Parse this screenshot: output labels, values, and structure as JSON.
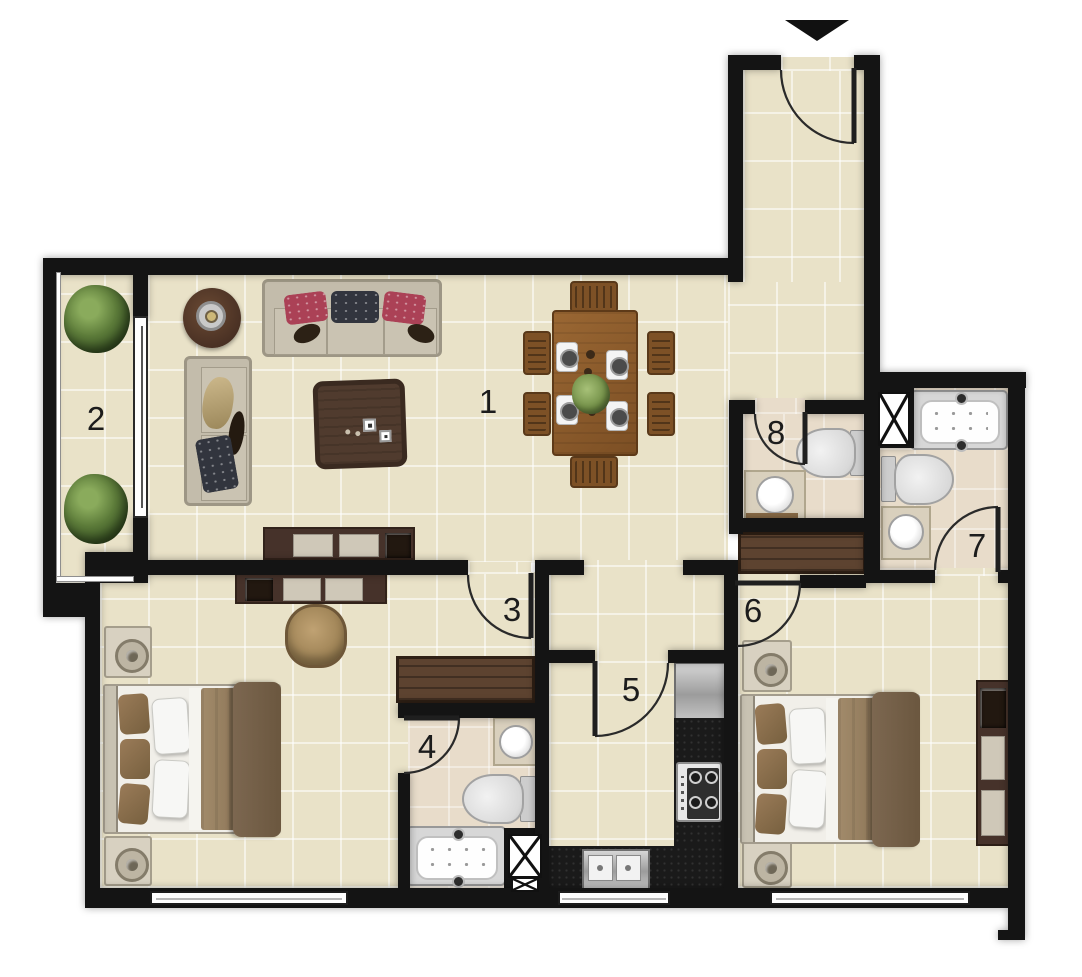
{
  "rooms": [
    {
      "label": "1"
    },
    {
      "label": "2"
    },
    {
      "label": "3"
    },
    {
      "label": "4"
    },
    {
      "label": "5"
    },
    {
      "label": "6"
    },
    {
      "label": "7"
    },
    {
      "label": "8"
    }
  ],
  "icons": {
    "entrance_arrow": "triangle-down"
  },
  "colors": {
    "wall": "#141414",
    "floor": "#e9e2c8",
    "bath_floor": "#e8dcca",
    "wood": "#95622f",
    "furn_dark": "#46322a",
    "sofa": "#c3bcab",
    "counter": "#1a1a1a",
    "stand": "#d8d1c1",
    "wardrobe": "#5d4330",
    "pillow_red": "#ab4156",
    "pillow_dark": "#32353e",
    "plant_green": "#5d7c3a",
    "door_line": "#2a2a2a"
  }
}
